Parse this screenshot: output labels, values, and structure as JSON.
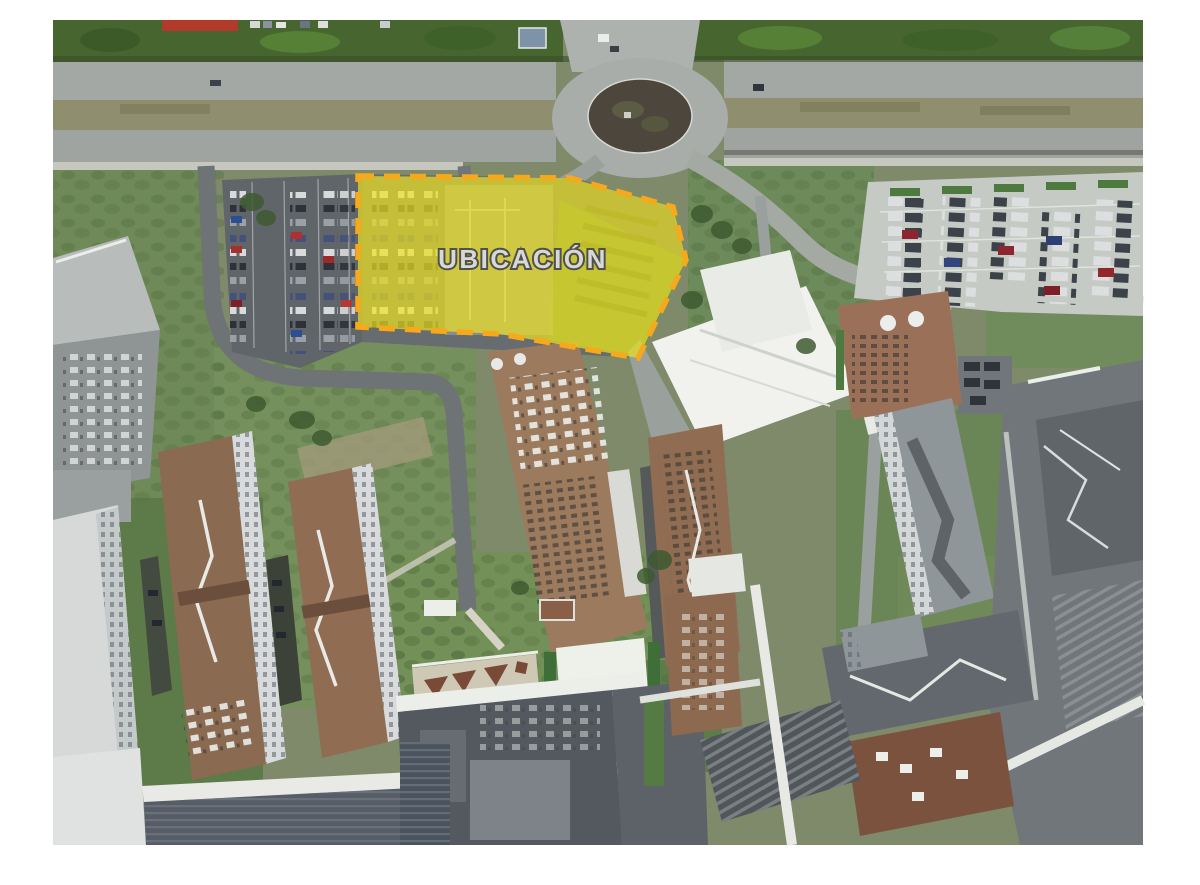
{
  "photo": {
    "kind": "aerial-photograph",
    "subject": "campus aerial view with highlighted site location"
  },
  "overlay": {
    "label": "UBICACIÓN",
    "fill": "#f0e51f",
    "fill_opacity": "0.68",
    "border": "#f7a91c",
    "label_fill": "#d8d8d5"
  },
  "regions": [
    {
      "name": "tree-line"
    },
    {
      "name": "divided-highway"
    },
    {
      "name": "roundabout"
    },
    {
      "name": "west-parking-lot"
    },
    {
      "name": "highlighted-site"
    },
    {
      "name": "east-parking-lot"
    },
    {
      "name": "campus-buildings-west"
    },
    {
      "name": "campus-buildings-center"
    },
    {
      "name": "campus-buildings-east"
    },
    {
      "name": "campus-buildings-south"
    },
    {
      "name": "access-roads"
    },
    {
      "name": "green-areas"
    }
  ]
}
